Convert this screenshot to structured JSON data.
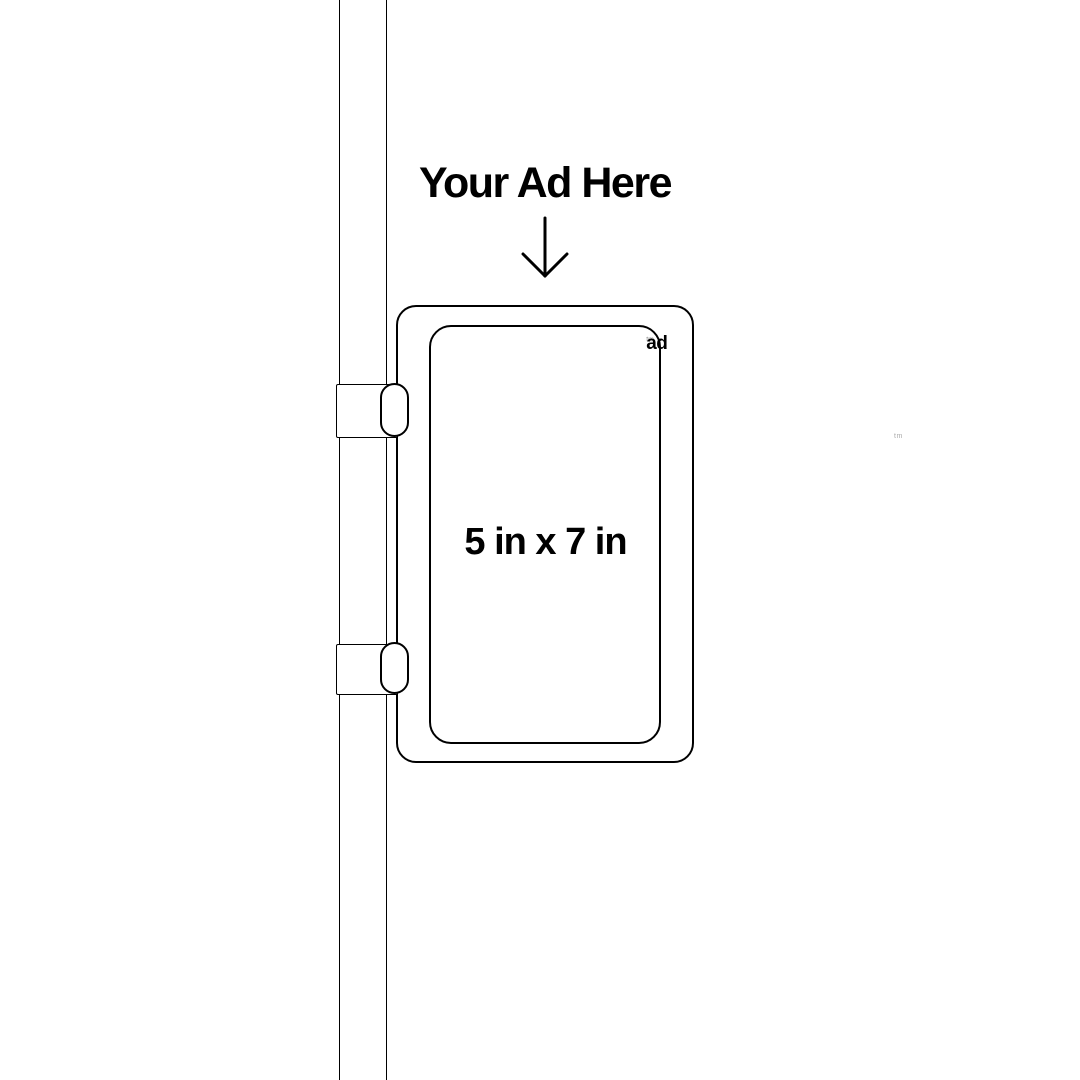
{
  "page": {
    "background": "#ffffff"
  },
  "headline": {
    "text": "Your Ad Here"
  },
  "arrow": {
    "icon": "down-arrow-icon",
    "direction": "down"
  },
  "sign": {
    "size_label": "5 in x 7 in",
    "brand": {
      "text": "ad",
      "trademark": "tm"
    }
  },
  "watermark": {
    "text": "tm"
  },
  "colors": {
    "line": "#000000",
    "text": "#000000",
    "brand_trademark": "#8a8a8a",
    "watermark": "#a9a9a9",
    "background": "#ffffff"
  }
}
